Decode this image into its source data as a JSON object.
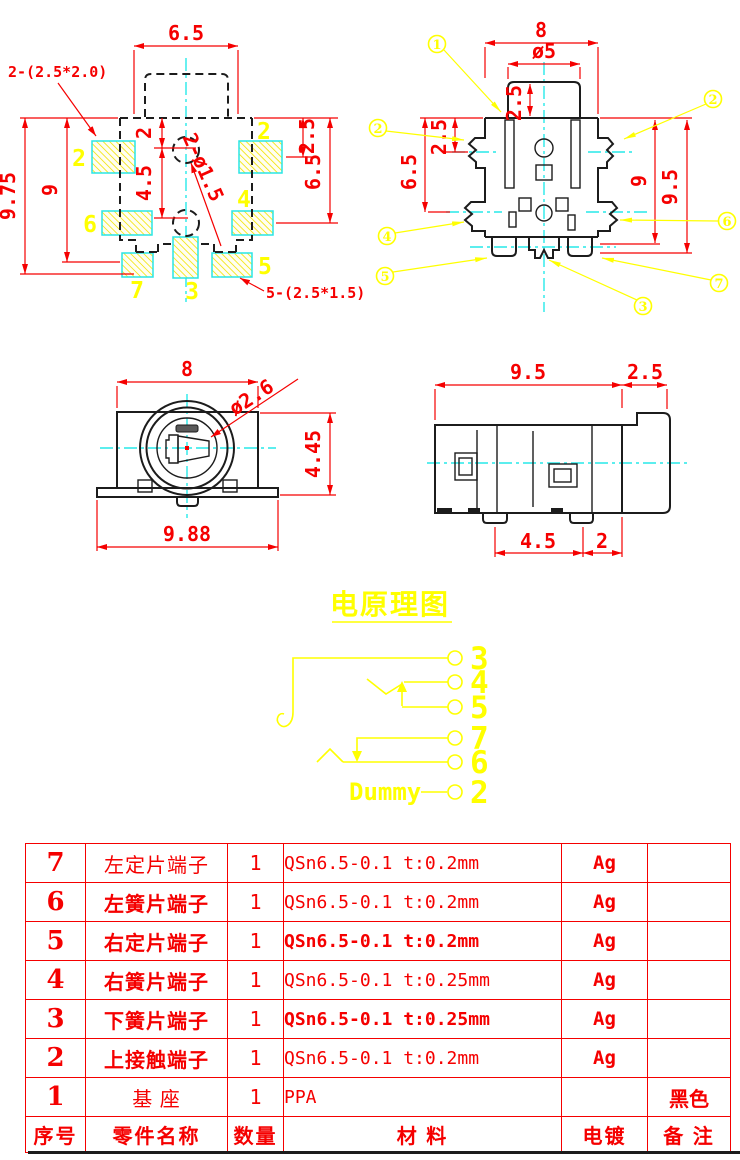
{
  "colors": {
    "dimension_red": "#f50000",
    "annotation_yellow": "#ffff00",
    "centerline_cyan": "#27e9e9",
    "outline_black": "#1c1c1c"
  },
  "fp": {
    "w": "6.5",
    "h": "9.75",
    "h2": "9",
    "o": "2",
    "p": "4.5",
    "r1": "2.5",
    "r2": "6.5",
    "holes": "2-ø1.5",
    "noteTop": "2-(2.5*2.0)",
    "noteBot": "5-(2.5*1.5)",
    "pads": [
      "2",
      "2",
      "6",
      "4",
      "7",
      "3",
      "5"
    ]
  },
  "bv": {
    "w": "8",
    "boss": "ø5",
    "bossH": "2.5",
    "l1": "2.5",
    "l2": "6.5",
    "r1": "9",
    "r2": "9.5",
    "callouts": [
      "1",
      "2",
      "2",
      "4",
      "5",
      "6",
      "7",
      "3"
    ]
  },
  "fv": {
    "w": "8",
    "bore": "ø2.6",
    "h": "4.45",
    "base": "9.88"
  },
  "sv": {
    "body": "9.5",
    "rear": "2.5",
    "pitch": "4.5",
    "edge": "2"
  },
  "sch": {
    "title": "电原理图",
    "dummy": "Dummy",
    "pins": [
      "3",
      "4",
      "5",
      "7",
      "6",
      "2"
    ]
  },
  "bom": {
    "header": {
      "no": "序号",
      "name": "零件名称",
      "qty": "数量",
      "material": "材  料",
      "plating": "电镀",
      "note": "备 注"
    },
    "rows": [
      {
        "no": "7",
        "name": "左定片端子",
        "qty": "1",
        "material": "QSn6.5-0.1  t:0.2mm",
        "plating": "Ag",
        "note": ""
      },
      {
        "no": "6",
        "name": "左簧片端子",
        "qty": "1",
        "material": "QSn6.5-0.1  t:0.2mm",
        "plating": "Ag",
        "note": ""
      },
      {
        "no": "5",
        "name": "右定片端子",
        "qty": "1",
        "material": "QSn6.5-0.1  t:0.2mm",
        "plating": "Ag",
        "note": ""
      },
      {
        "no": "4",
        "name": "右簧片端子",
        "qty": "1",
        "material": "QSn6.5-0.1  t:0.25mm",
        "plating": "Ag",
        "note": ""
      },
      {
        "no": "3",
        "name": "下簧片端子",
        "qty": "1",
        "material": "QSn6.5-0.1  t:0.25mm",
        "plating": "Ag",
        "note": ""
      },
      {
        "no": "2",
        "name": "上接触端子",
        "qty": "1",
        "material": "QSn6.5-0.1  t:0.2mm",
        "plating": "Ag",
        "note": ""
      },
      {
        "no": "1",
        "name": "基  座",
        "qty": "1",
        "material": "PPA",
        "plating": "",
        "note": "黑色"
      }
    ]
  }
}
